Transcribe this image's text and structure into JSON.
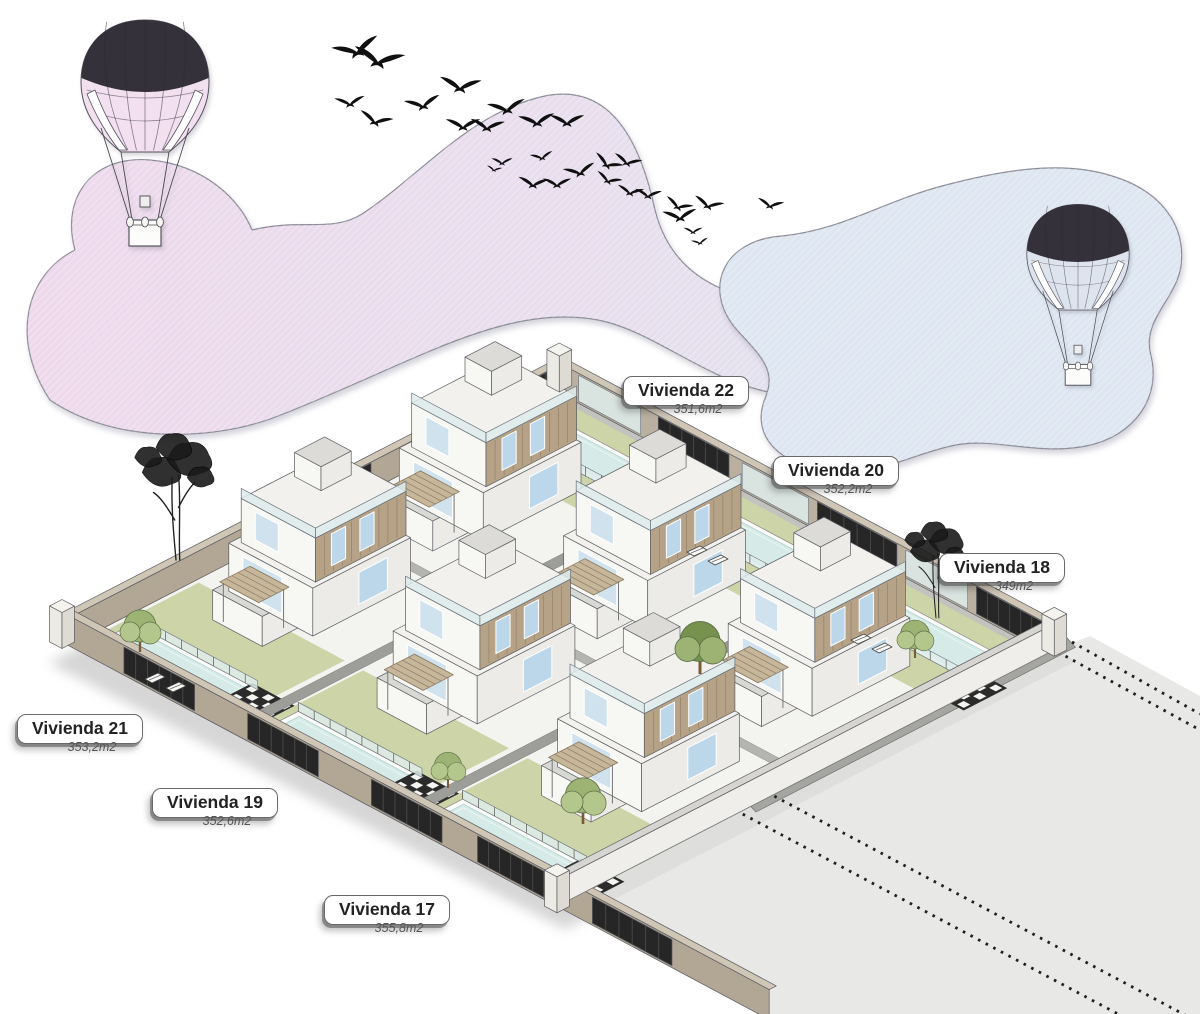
{
  "site": {
    "viviendas": [
      {
        "label": "Vivienda 22",
        "area": "351,6m2",
        "x": 686,
        "y": 391
      },
      {
        "label": "Vivienda 20",
        "area": "352,2m2",
        "x": 836,
        "y": 471
      },
      {
        "label": "Vivienda 18",
        "area": "349m2",
        "x": 1002,
        "y": 568
      },
      {
        "label": "Vivienda 21",
        "area": "353,2m2",
        "x": 80,
        "y": 729
      },
      {
        "label": "Vivienda 19",
        "area": "352,6m2",
        "x": 215,
        "y": 803
      },
      {
        "label": "Vivienda 17",
        "area": "355,8m2",
        "x": 387,
        "y": 910
      }
    ]
  },
  "colors": {
    "cloud_pink": "#eed9ec",
    "cloud_pink_right": "#e2e2ef",
    "cloud_blue": "#dde6f1",
    "cloud_outline": "#8d8d99",
    "balloon_dark": "#35313a",
    "balloon1_tint": "#f2dff0",
    "balloon2_tint": "#dde4ee",
    "bird": "#101010",
    "plot_base": "#f3f3f0",
    "lawn": "#ccd4a8",
    "pool_water": "#d6ebe7",
    "pool_rim": "#a8cdc6",
    "pool_coping": "#fbfbf9",
    "path_gray": "#9d9d9a",
    "spine_gray": "#b4b4b0",
    "road": "#e8e8e7",
    "wall_tan_face": "#b2a694",
    "wall_tan_top": "#cfc6b6",
    "fence_dark": "#262626",
    "fence_slat": "#4a4a4a",
    "wall_white": "#efeeea",
    "wall_white_top": "#d6d5d1",
    "house_left": "#f7f7f4",
    "house_right": "#ecebe7",
    "roof": "#f2f1ed",
    "annex_roof": "#d8d8d4",
    "wood": "#b5a287",
    "wood_line": "#8d7c63",
    "glass_window": "#bcd7e9",
    "glass_door": "#cfe2ee",
    "glass_balustrade": "rgba(222,236,235,0.85)",
    "edge": "#5a5b60",
    "dotted_line": "#1f1f1f",
    "tree_green": "#9db374",
    "tree_green_light": "#b3c68c",
    "tree_green_dark": "#77924f",
    "tree_sketch": "#1a1a1a"
  },
  "balloons": [
    {
      "name": "hot-air-balloon-left",
      "x": 145,
      "y": 92,
      "scale": 1.0,
      "tint": "#f2dff0"
    },
    {
      "name": "hot-air-balloon-right",
      "x": 1078,
      "y": 262,
      "scale": 0.8,
      "tint": "#dde4ee"
    }
  ],
  "birds": [
    [
      357,
      52,
      1.25,
      -15
    ],
    [
      378,
      62,
      1.35,
      10
    ],
    [
      350,
      104,
      0.8,
      -5
    ],
    [
      375,
      122,
      0.9,
      15
    ],
    [
      423,
      106,
      0.95,
      -10
    ],
    [
      460,
      88,
      1.1,
      5
    ],
    [
      507,
      110,
      1.0,
      -8
    ],
    [
      463,
      127,
      0.9,
      0
    ],
    [
      487,
      128,
      0.9,
      5
    ],
    [
      537,
      123,
      0.95,
      -5
    ],
    [
      567,
      123,
      0.9,
      0
    ],
    [
      502,
      163,
      0.55,
      0
    ],
    [
      494,
      170,
      0.4,
      10
    ],
    [
      542,
      158,
      0.6,
      -10
    ],
    [
      533,
      185,
      0.8,
      5
    ],
    [
      557,
      185,
      0.75,
      0
    ],
    [
      580,
      173,
      0.85,
      -12
    ],
    [
      607,
      165,
      0.8,
      25
    ],
    [
      608,
      181,
      0.7,
      20
    ],
    [
      627,
      163,
      0.75,
      15
    ],
    [
      630,
      193,
      0.7,
      10
    ],
    [
      648,
      196,
      0.7,
      5
    ],
    [
      678,
      207,
      0.75,
      20
    ],
    [
      680,
      218,
      0.9,
      -5
    ],
    [
      708,
      206,
      0.8,
      15
    ],
    [
      770,
      206,
      0.7,
      10
    ],
    [
      693,
      232,
      0.5,
      0
    ],
    [
      700,
      243,
      0.45,
      -10
    ]
  ]
}
